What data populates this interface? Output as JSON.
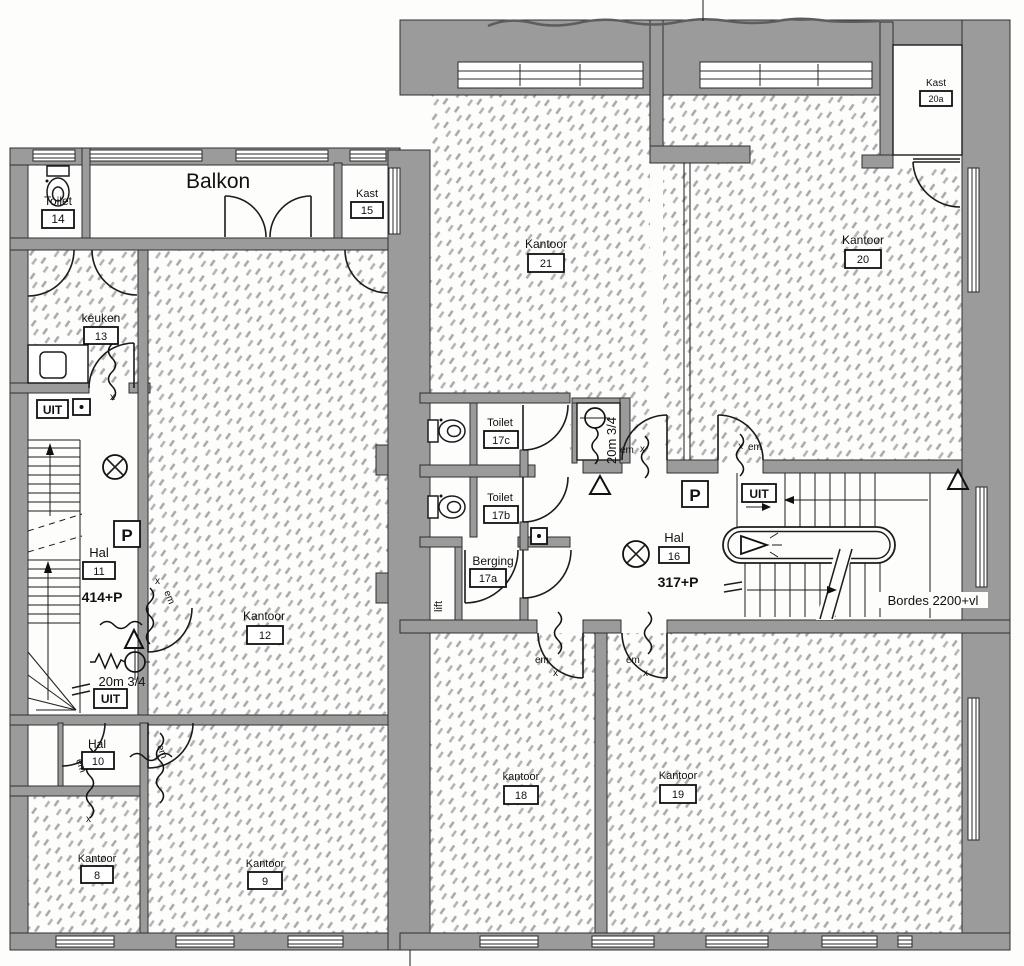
{
  "drawing": {
    "kind": "scanned office floor plan",
    "language": "nl"
  },
  "rooms": {
    "balkon": {
      "name": "Balkon"
    },
    "toilet14": {
      "name": "Toilet",
      "number": "14"
    },
    "kast15": {
      "name": "Kast",
      "number": "15"
    },
    "keuken13": {
      "name": "keuken",
      "number": "13"
    },
    "hal11": {
      "name": "Hal",
      "number": "11",
      "elevation": "414+P"
    },
    "kantoor12": {
      "name": "Kantoor",
      "number": "12"
    },
    "hal10": {
      "name": "Hal",
      "number": "10"
    },
    "kantoor8": {
      "name": "Kantoor",
      "number": "8"
    },
    "kantoor9": {
      "name": "Kantoor",
      "number": "9"
    },
    "kantoor21": {
      "name": "Kantoor",
      "number": "21"
    },
    "kantoor20": {
      "name": "Kantoor",
      "number": "20"
    },
    "kast20a": {
      "name": "Kast",
      "number": "20a"
    },
    "toilet17c": {
      "name": "Toilet",
      "number": "17c"
    },
    "toilet17b": {
      "name": "Toilet",
      "number": "17b"
    },
    "berging17a": {
      "name": "Berging",
      "number": "17a"
    },
    "lift": {
      "name": "lift"
    },
    "hal16": {
      "name": "Hal",
      "number": "16",
      "elevation": "317+P"
    },
    "kantoor18": {
      "name": "kantoor",
      "number": "18"
    },
    "kantoor19": {
      "name": "Kantoor",
      "number": "19"
    }
  },
  "annotations": {
    "exit": "UIT",
    "riser": "P",
    "emergency": "em",
    "hose": "20m 3/4",
    "landing": "Bordes 2200+vl",
    "cross": "x"
  }
}
